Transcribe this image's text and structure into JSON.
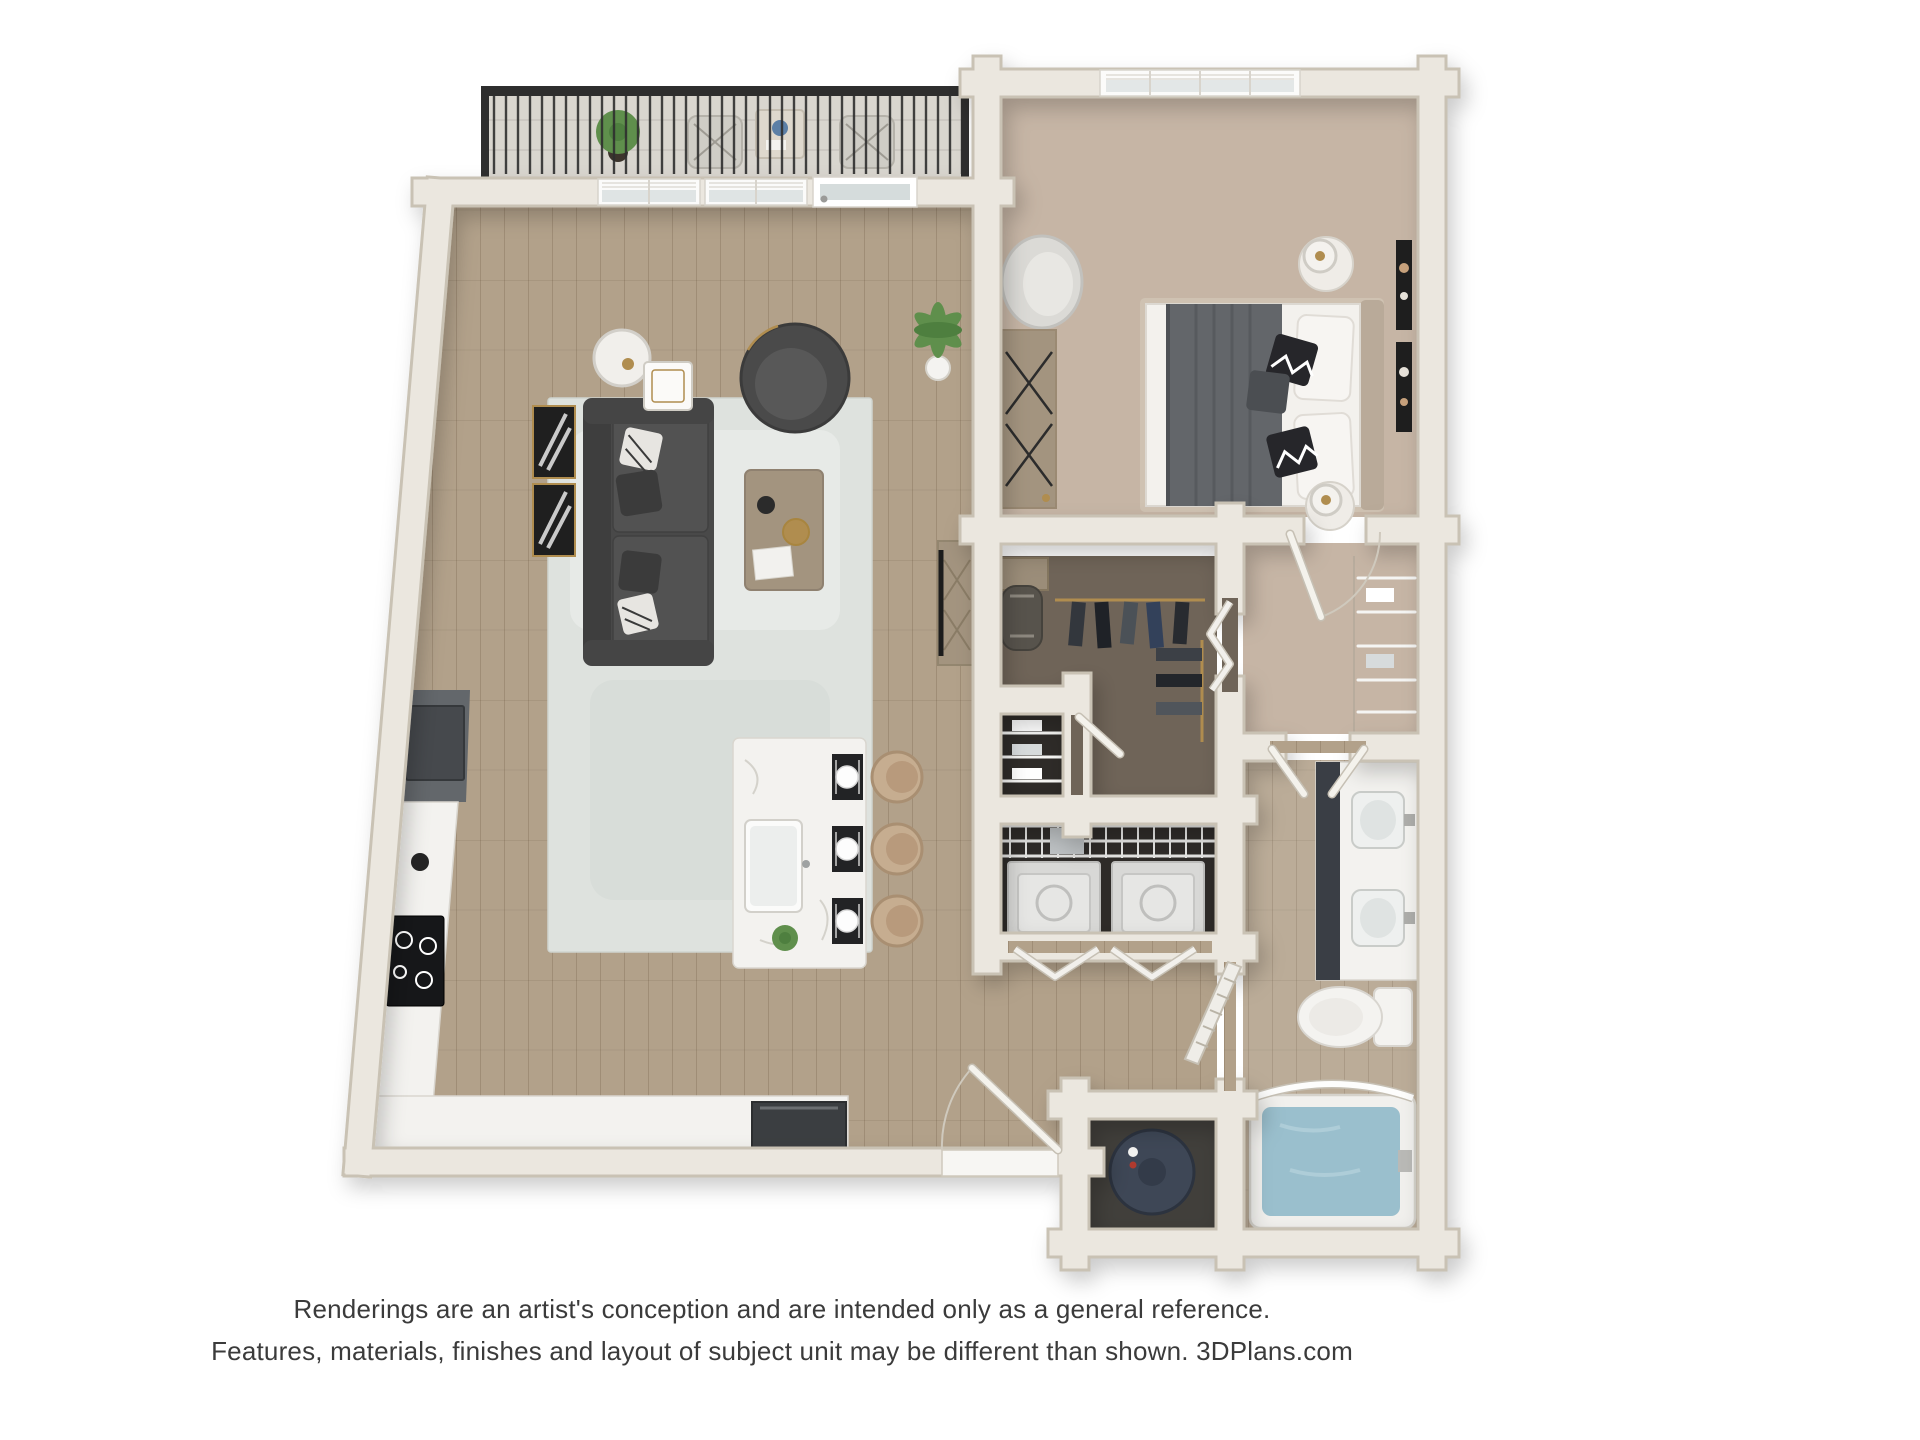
{
  "image_type": "3d-floor-plan-rendering",
  "disclaimer": {
    "line1": "Renderings are an artist's conception and are intended only as a general reference.",
    "line2": "Features, materials, finishes and layout of subject unit may be different than shown. 3DPlans.com"
  },
  "branding": {
    "watermark": "3DPlans.com"
  },
  "colors": {
    "page_bg": "#ffffff",
    "wall": "#ebe7df",
    "wall_edge": "#c9c2b4",
    "wood": "#b2a18a",
    "wood_line": "#8f7f68",
    "carpet": "#c6b5a5",
    "closet_carpet": "#6f6458",
    "dark_floor": "#2e2b28",
    "balcony_floor": "#d9d6cf",
    "rug": "#dee2de",
    "sofa": "#494949",
    "wood_furniture": "#a3947f",
    "marble": "#f3f2ef",
    "cabinet_slate": "#63676b",
    "refrigerator": "#46494d",
    "stove": "#161719",
    "bed_linen": "#f3f1ed",
    "blanket": "#63666a",
    "headboard": "#b9aa99",
    "vanity_cabinet": "#3a3e45",
    "fixture_white": "#f4f3f0",
    "tub_water": "#9abfcd",
    "water_heater": "#3e4756",
    "railing": "#2e2e2e",
    "plant": "#5f8f4c",
    "gold": "#b08d4f",
    "appliance_light": "#d8d8d6",
    "wire_shelf": "#f5f5f3",
    "text": "#3b3b3b"
  }
}
